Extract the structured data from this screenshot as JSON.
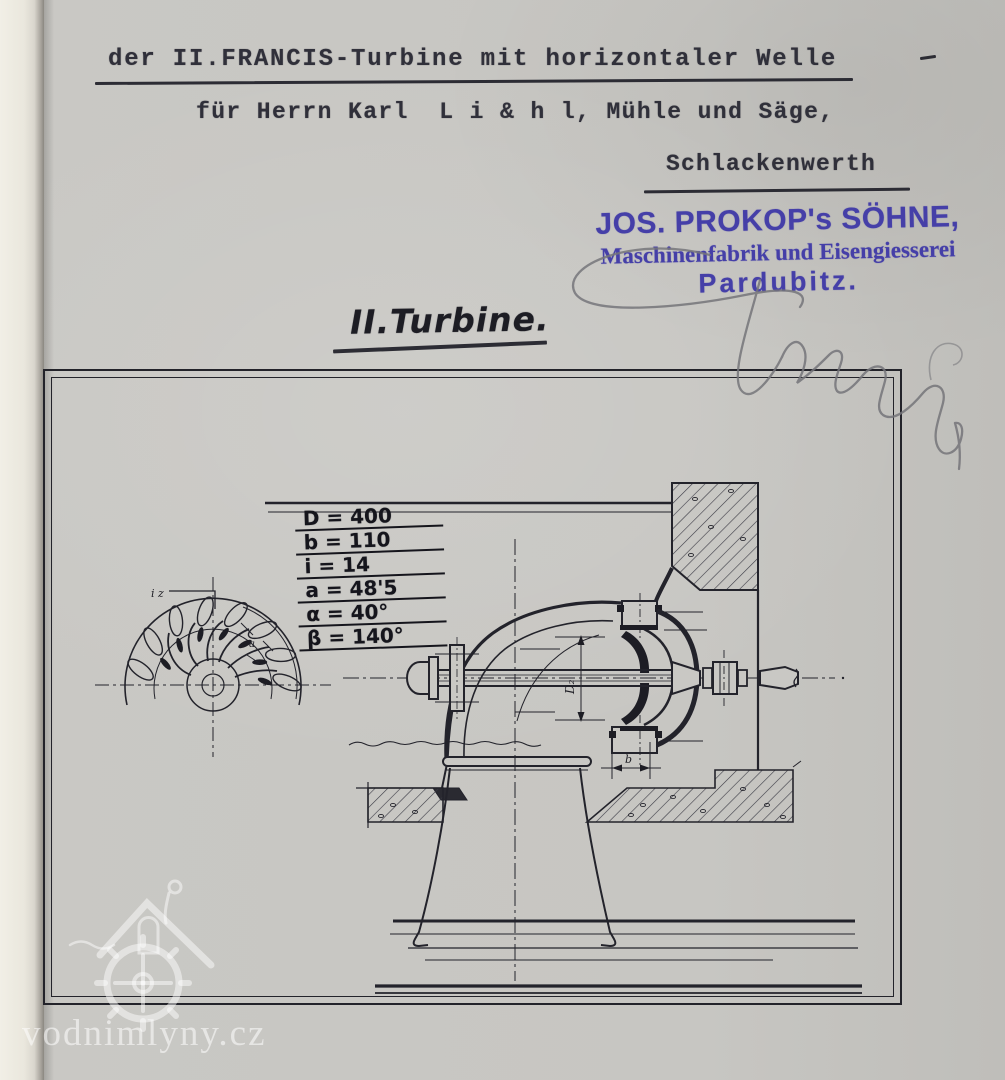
{
  "document": {
    "line1": "der II.FRANCIS-Turbine mit horizontaler Welle",
    "line2": "für Herrn Karl  L i & h l, Mühle und Säge,",
    "line3": "Schlackenwerth"
  },
  "stamp": {
    "line1": "JOS. PROKOP's SÖHNE,",
    "line2": "Maschinenfabrik und Eisengiesserei",
    "line3": "Pardubitz.",
    "ink_color": "#453fa8"
  },
  "drawing": {
    "caption": "II.Turbine.",
    "parameters": [
      {
        "text": "D = 400"
      },
      {
        "text": "b = 110"
      },
      {
        "text": "i = 14"
      },
      {
        "text": "a = 48'5"
      },
      {
        "text": "α = 40°"
      },
      {
        "text": "β = 140°"
      }
    ],
    "labels": {
      "wheel_detail": "i z",
      "vane": "a",
      "runner_diameter": "D₂",
      "runner_width": "b"
    }
  },
  "watermark": {
    "text": "vodnimlyny.cz"
  }
}
